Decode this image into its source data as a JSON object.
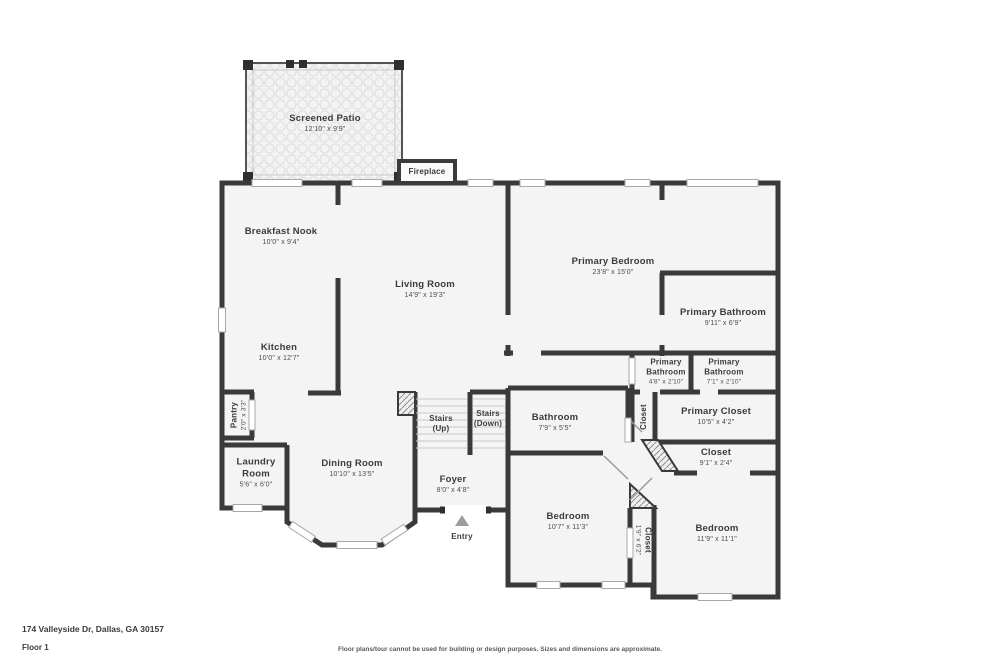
{
  "rooms": {
    "screened_patio": {
      "name": "Screened Patio",
      "dims": "12'10\" x 9'9\""
    },
    "breakfast_nook": {
      "name": "Breakfast Nook",
      "dims": "10'0\" x 9'4\""
    },
    "living_room": {
      "name": "Living Room",
      "dims": "14'9\" x 19'3\""
    },
    "primary_bedroom": {
      "name": "Primary Bedroom",
      "dims": "23'8\" x 15'0\""
    },
    "primary_bathroom": {
      "name": "Primary Bathroom",
      "dims": "9'11\" x 6'9\""
    },
    "kitchen": {
      "name": "Kitchen",
      "dims": "10'0\" x 12'7\""
    },
    "primary_bathroom_a": {
      "name": "Primary Bathroom",
      "dims": "4'8\" x 2'10\""
    },
    "primary_bathroom_b": {
      "name": "Primary Bathroom",
      "dims": "7'1\" x 2'10\""
    },
    "pantry": {
      "name": "Pantry",
      "dims": "2'0\" x 3'3\""
    },
    "bathroom": {
      "name": "Bathroom",
      "dims": "7'9\" x 5'5\""
    },
    "closet_small": {
      "name": "Closet"
    },
    "primary_closet": {
      "name": "Primary Closet",
      "dims": "10'5\" x 4'2\""
    },
    "laundry_room": {
      "name": "Laundry Room",
      "dims": "5'6\" x 6'0\""
    },
    "dining_room": {
      "name": "Dining Room",
      "dims": "10'10\" x 13'5\""
    },
    "closet_hall": {
      "name": "Closet",
      "dims": "9'1\" x 2'4\""
    },
    "foyer": {
      "name": "Foyer",
      "dims": "8'0\" x 4'8\""
    },
    "bedroom_left": {
      "name": "Bedroom",
      "dims": "10'7\" x 11'3\""
    },
    "closet_between": {
      "name": "Closet",
      "dims": "1'9\" x 6'2\""
    },
    "bedroom_right": {
      "name": "Bedroom",
      "dims": "11'9\" x 11'1\""
    }
  },
  "labels": {
    "fireplace": "Fireplace",
    "entry": "Entry",
    "stairs_up": "Stairs",
    "stairs_up_sub": "(Up)",
    "stairs_down": "Stairs",
    "stairs_down_sub": "(Down)"
  },
  "footer": {
    "address": "174 Valleyside Dr, Dallas, GA 30157",
    "floor": "Floor 1",
    "disclaimer": "Floor plans/tour cannot be used for building or design purposes. Sizes and dimensions are approximate."
  },
  "colors": {
    "wall": "#3a3a3a",
    "room_fill": "#f4f4f4",
    "window": "#ffffff",
    "entry_arrow": "#9c9c9c"
  }
}
